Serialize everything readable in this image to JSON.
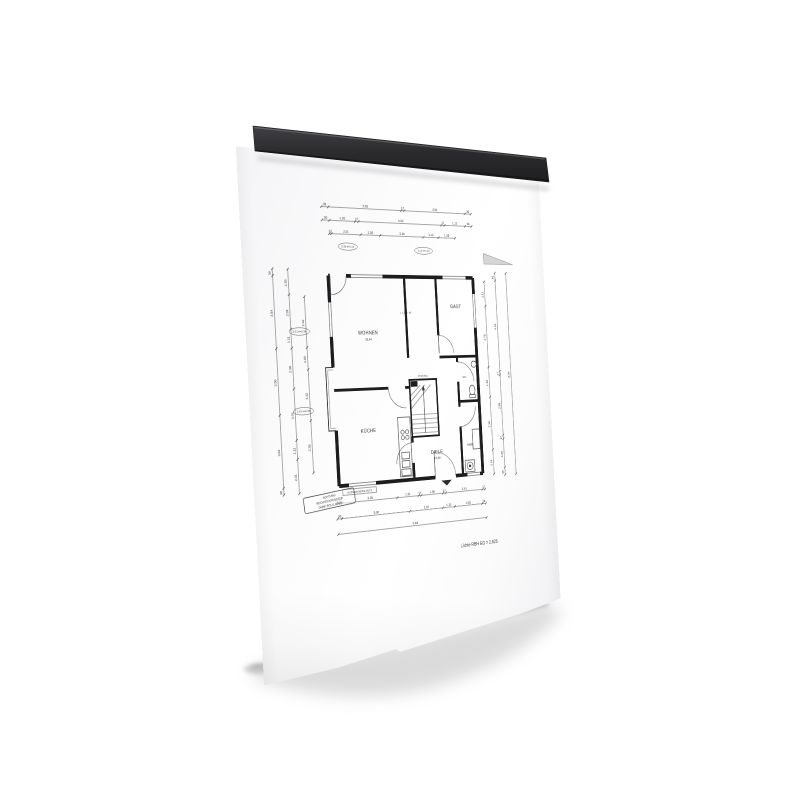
{
  "scene": {
    "description": "Black magnetic clamp rail holding an architectural floor-plan sheet",
    "background_color": "#ffffff",
    "rail_color": "#2c2c2f",
    "paper_color": "#fbfbfc",
    "shadow_color": "#b8b8ba",
    "ink_color": "#2e2e2e"
  },
  "drawing": {
    "rooms": [
      {
        "name": "WOHNEN",
        "area": "28,44"
      },
      {
        "name": "GAST",
        "area": ""
      },
      {
        "name": "DIELE",
        "area": "10,48"
      },
      {
        "name": "KÜCHE",
        "area": ""
      },
      {
        "name": "HWR",
        "area": ""
      },
      {
        "name": "WC",
        "area": ""
      }
    ],
    "stair_label": "17/18 Stg",
    "annotation": "+ 1,50 + 87",
    "stamp": {
      "lines": [
        "ACHTUNG",
        "RECHTECKFENSTER",
        "OHNE ROLLLADEN"
      ]
    },
    "edge_label": "AUSSENKANTE PUTZ",
    "bottom_note": "Lichte RBH EG = 2.625",
    "window_tags": [
      "2.38 h=1.13",
      "1.13 h=1.13",
      "2.01 h=2.38",
      "2.01 h=2.38"
    ],
    "dim_chains": {
      "top1": [
        "36",
        "3.93",
        "17",
        "3.51",
        "36"
      ],
      "top2": [
        "36",
        "1.26",
        "17",
        "4.32",
        "17",
        "1.13",
        "36"
      ],
      "top3": [
        "12",
        "2.01",
        "1.38",
        "3.16",
        "1.13",
        "1.26"
      ],
      "left1": [
        "36",
        "3.84",
        "3.50",
        "3.84",
        "36"
      ],
      "left2": [
        "1.50",
        "2.01",
        "1.11",
        "2.38",
        "3.01",
        "1.11",
        "2.01"
      ],
      "left3": [
        "2.32",
        "1.00",
        "2.32",
        "2.38"
      ],
      "right1": [
        "1.11",
        "2.76",
        "1.36",
        "2.38",
        "1.11"
      ],
      "right2": [
        "36",
        "4.32",
        "17",
        "2.88",
        "17",
        "1.36",
        "36"
      ],
      "right3": [
        "8.04"
      ],
      "bottom1": [
        "17",
        "11",
        "3.26",
        "1.31",
        "17",
        "1.38",
        "17",
        "2.41",
        "17"
      ],
      "bottom2": [
        "36",
        "5.90",
        "3.02",
        "1.13",
        "2.62",
        "36"
      ],
      "bottom3": [
        "9.48"
      ]
    }
  }
}
